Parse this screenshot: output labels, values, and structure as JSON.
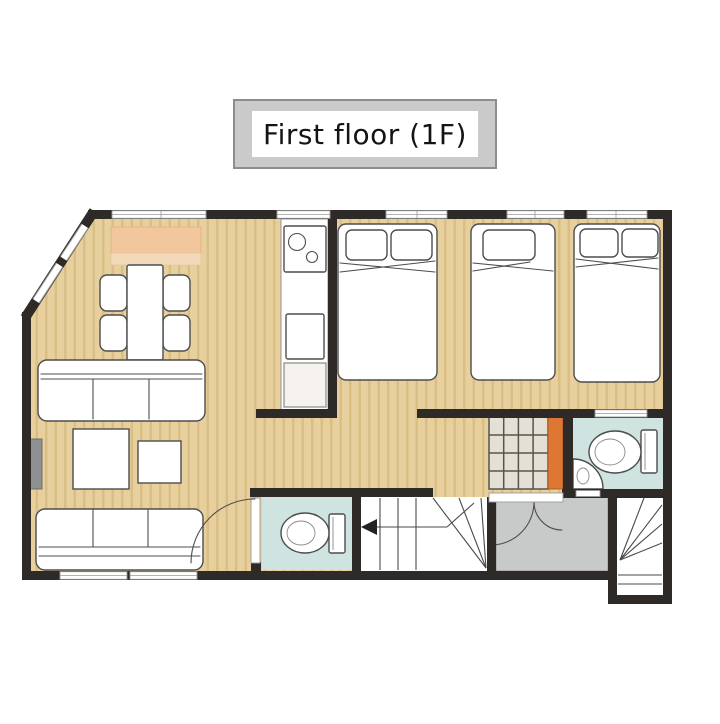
{
  "title": {
    "label": "First floor (1F)"
  },
  "semantics": {
    "beds": 3,
    "toilet_rooms": 2,
    "sofas": 2,
    "dining_chairs": 4,
    "coffee_tables": 2,
    "staircases": 1,
    "entrance_door_leaves": 2
  },
  "colors": {
    "page_background": "#ffffff",
    "wall": "#2d2a28",
    "wood_floor": "#e8d09e",
    "wood_stripe": "#d9bf86",
    "rug": "#f3c79e",
    "rug_fringe": "#f1d9ba",
    "bathroom_floor": "#cfe3e0",
    "entrance_floor": "#c8cac9",
    "exterior_step_floor": "#ffffff",
    "closet_shelf": "#e5e0d5",
    "closet_grid_line": "#57544d",
    "closet_door": "#dd7733",
    "furniture_line": "#4d4d4d",
    "window_border": "#999999",
    "tv_screen": "#8e9092",
    "title_box_bg": "#cbcaca",
    "title_box_border": "#8d8d8d",
    "title_text": "#141414"
  }
}
